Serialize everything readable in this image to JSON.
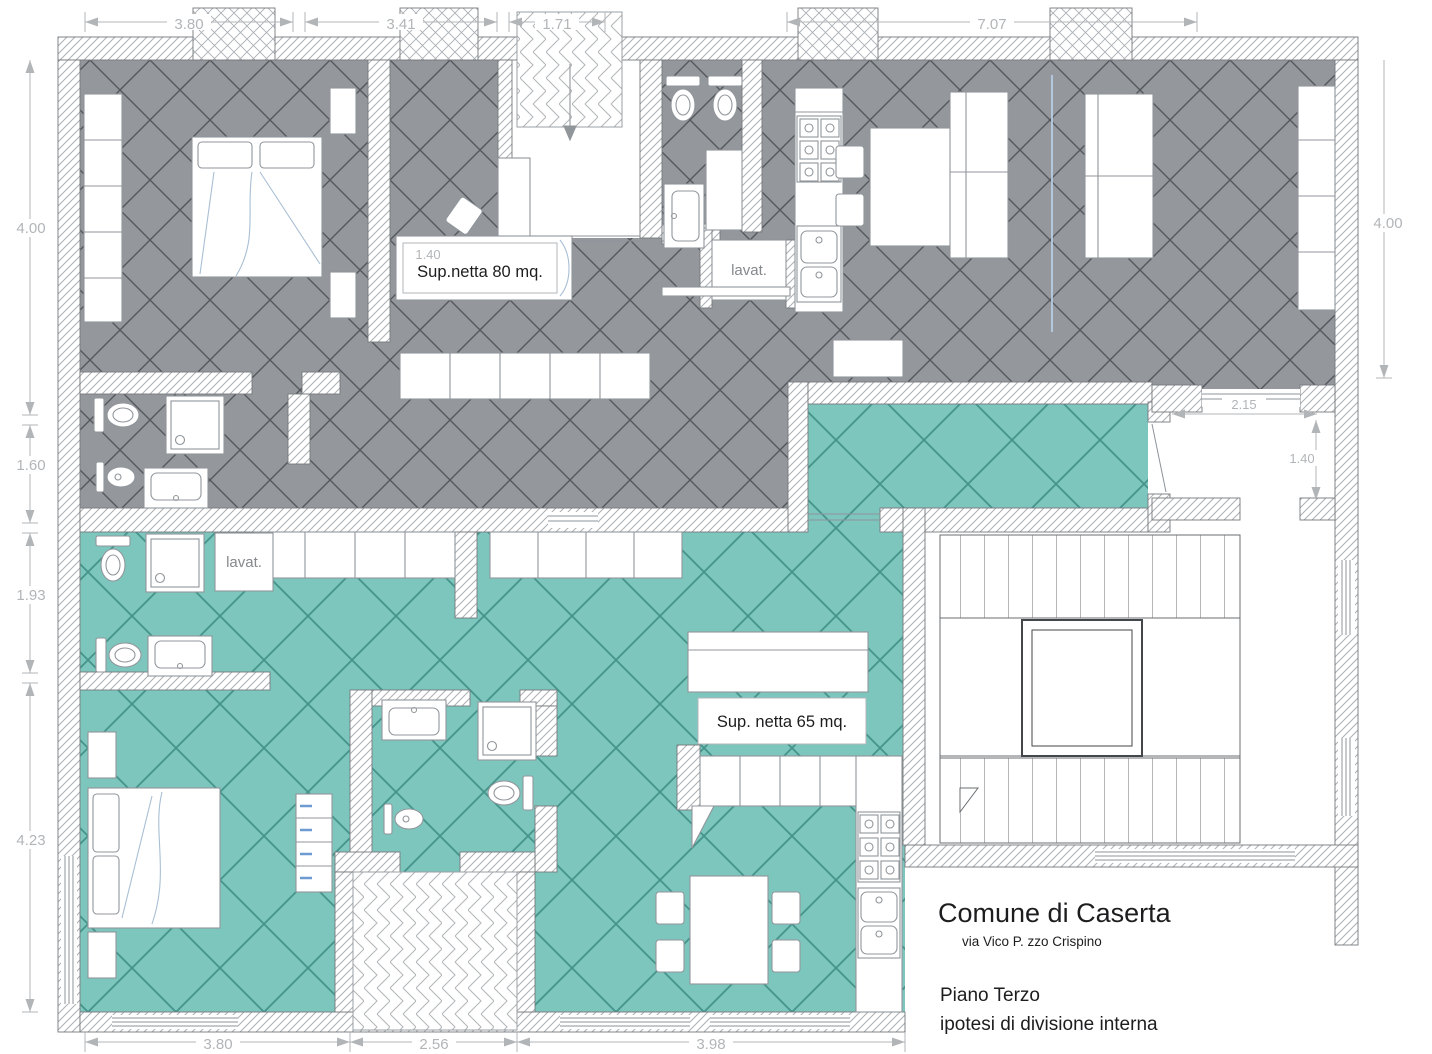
{
  "plan": {
    "apartment1": {
      "area_label": "Sup.netta 80 mq.",
      "laundry_label": "lavat.",
      "faint_dim": "1.40"
    },
    "apartment2": {
      "area_label": "Sup. netta 65 mq.",
      "laundry_label": "lavat."
    },
    "dimensions": {
      "top": [
        "3.80",
        "3.41",
        "1.71",
        "7.07"
      ],
      "left": [
        "4.00",
        "1.60",
        "1.93",
        "4.23"
      ],
      "right": [
        "4.00"
      ],
      "balcony": [
        "2.15",
        "1.40"
      ],
      "bottom": [
        "3.80",
        "2.56",
        "3.98"
      ]
    },
    "title_block": {
      "municipality": "Comune di Caserta",
      "address": "via Vico P. zzo  Crispino",
      "floor": "Piano Terzo",
      "subtitle": "ipotesi di divisione interna"
    },
    "colors": {
      "apartment1_fill": "#94989d",
      "apartment1_grid": "#54585d",
      "apartment2_fill": "#7dc6bd",
      "apartment2_grid": "#44948b",
      "wall_hatch": "#abb0b5",
      "wall_edge": "#75797d",
      "fixture_line": "#91969b",
      "fixture_text": "#85898d",
      "dimension": "#b2b5b8",
      "text": "#1d1d1f",
      "sketch_blue": "#a9bfd4",
      "crease_blue": "#b9d0e8",
      "drawer_handle_blue": "#6d9bd1",
      "stair_line": "#6a6e72"
    }
  }
}
